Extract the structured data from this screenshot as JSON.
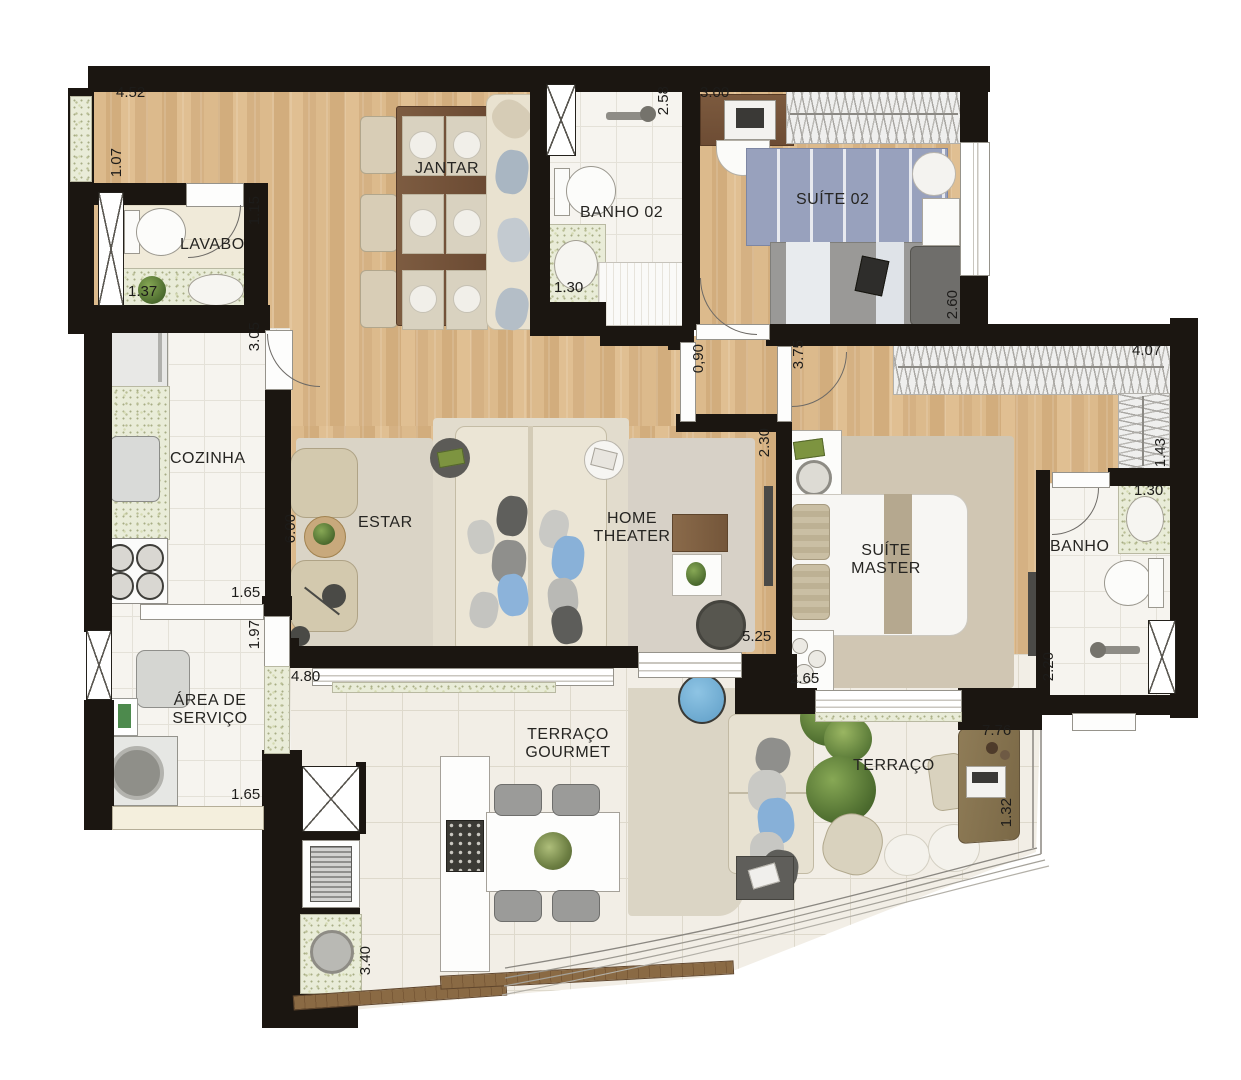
{
  "palette": {
    "wall": "#1b1611",
    "wood_floor": "#d8b486",
    "tile_floor": "#f6f4ef",
    "terrace_tile": "#f2eee6",
    "granite_counter": "#e9ecd8",
    "rug": "#d4ccba",
    "sofa_cream": "#ebe5d5",
    "bed_blue": "#98a1bd",
    "accent_blue_pillow": "#89b1d8",
    "dark_table": "#7a5a40"
  },
  "rooms": {
    "jantar": "JANTAR",
    "banho02": "BANHO 02",
    "suite02": "SUÍTE 02",
    "lavabo": "LAVABO",
    "cozinha": "COZINHA",
    "estar": "ESTAR",
    "home_theater_line1": "HOME",
    "home_theater_line2": "THEATER",
    "suite_master_line1": "SUÍTE",
    "suite_master_line2": "MASTER",
    "banho": "BANHO",
    "area_servico_line1": "ÁREA DE",
    "area_servico_line2": "SERVIÇO",
    "terraco_gourmet_line1": "TERRAÇO",
    "terraco_gourmet_line2": "GOURMET",
    "terraco": "TERRAÇO"
  },
  "dims": {
    "jantar_width": "4.52",
    "jantar_left": "1.07",
    "lavabo_depth": "1.15",
    "lavabo_width": "1.37",
    "cozinha_door": "3.05",
    "cozinha_pass": "1.65",
    "servico_depth": "1.97",
    "servico_width": "1.65",
    "estar_height": "6.00",
    "gourmet_width": "4.80",
    "gourmet_counter": "3.40",
    "banho02_depth": "2.58",
    "banho02_sink": "1.30",
    "suite02_desk": "3.00",
    "suite02_depth": "2.60",
    "hall_width": "0,90",
    "corredor": "3.75",
    "closet_width": "4.07",
    "closet_depth": "1.43",
    "banho_sink": "1.30",
    "banho_shower": "2.20",
    "suite_master_tv": "2.30",
    "suite_master_len": "5.25",
    "suite_master_win": "2.65",
    "terraco_len": "7.76",
    "terraco_desk": "1.32"
  }
}
